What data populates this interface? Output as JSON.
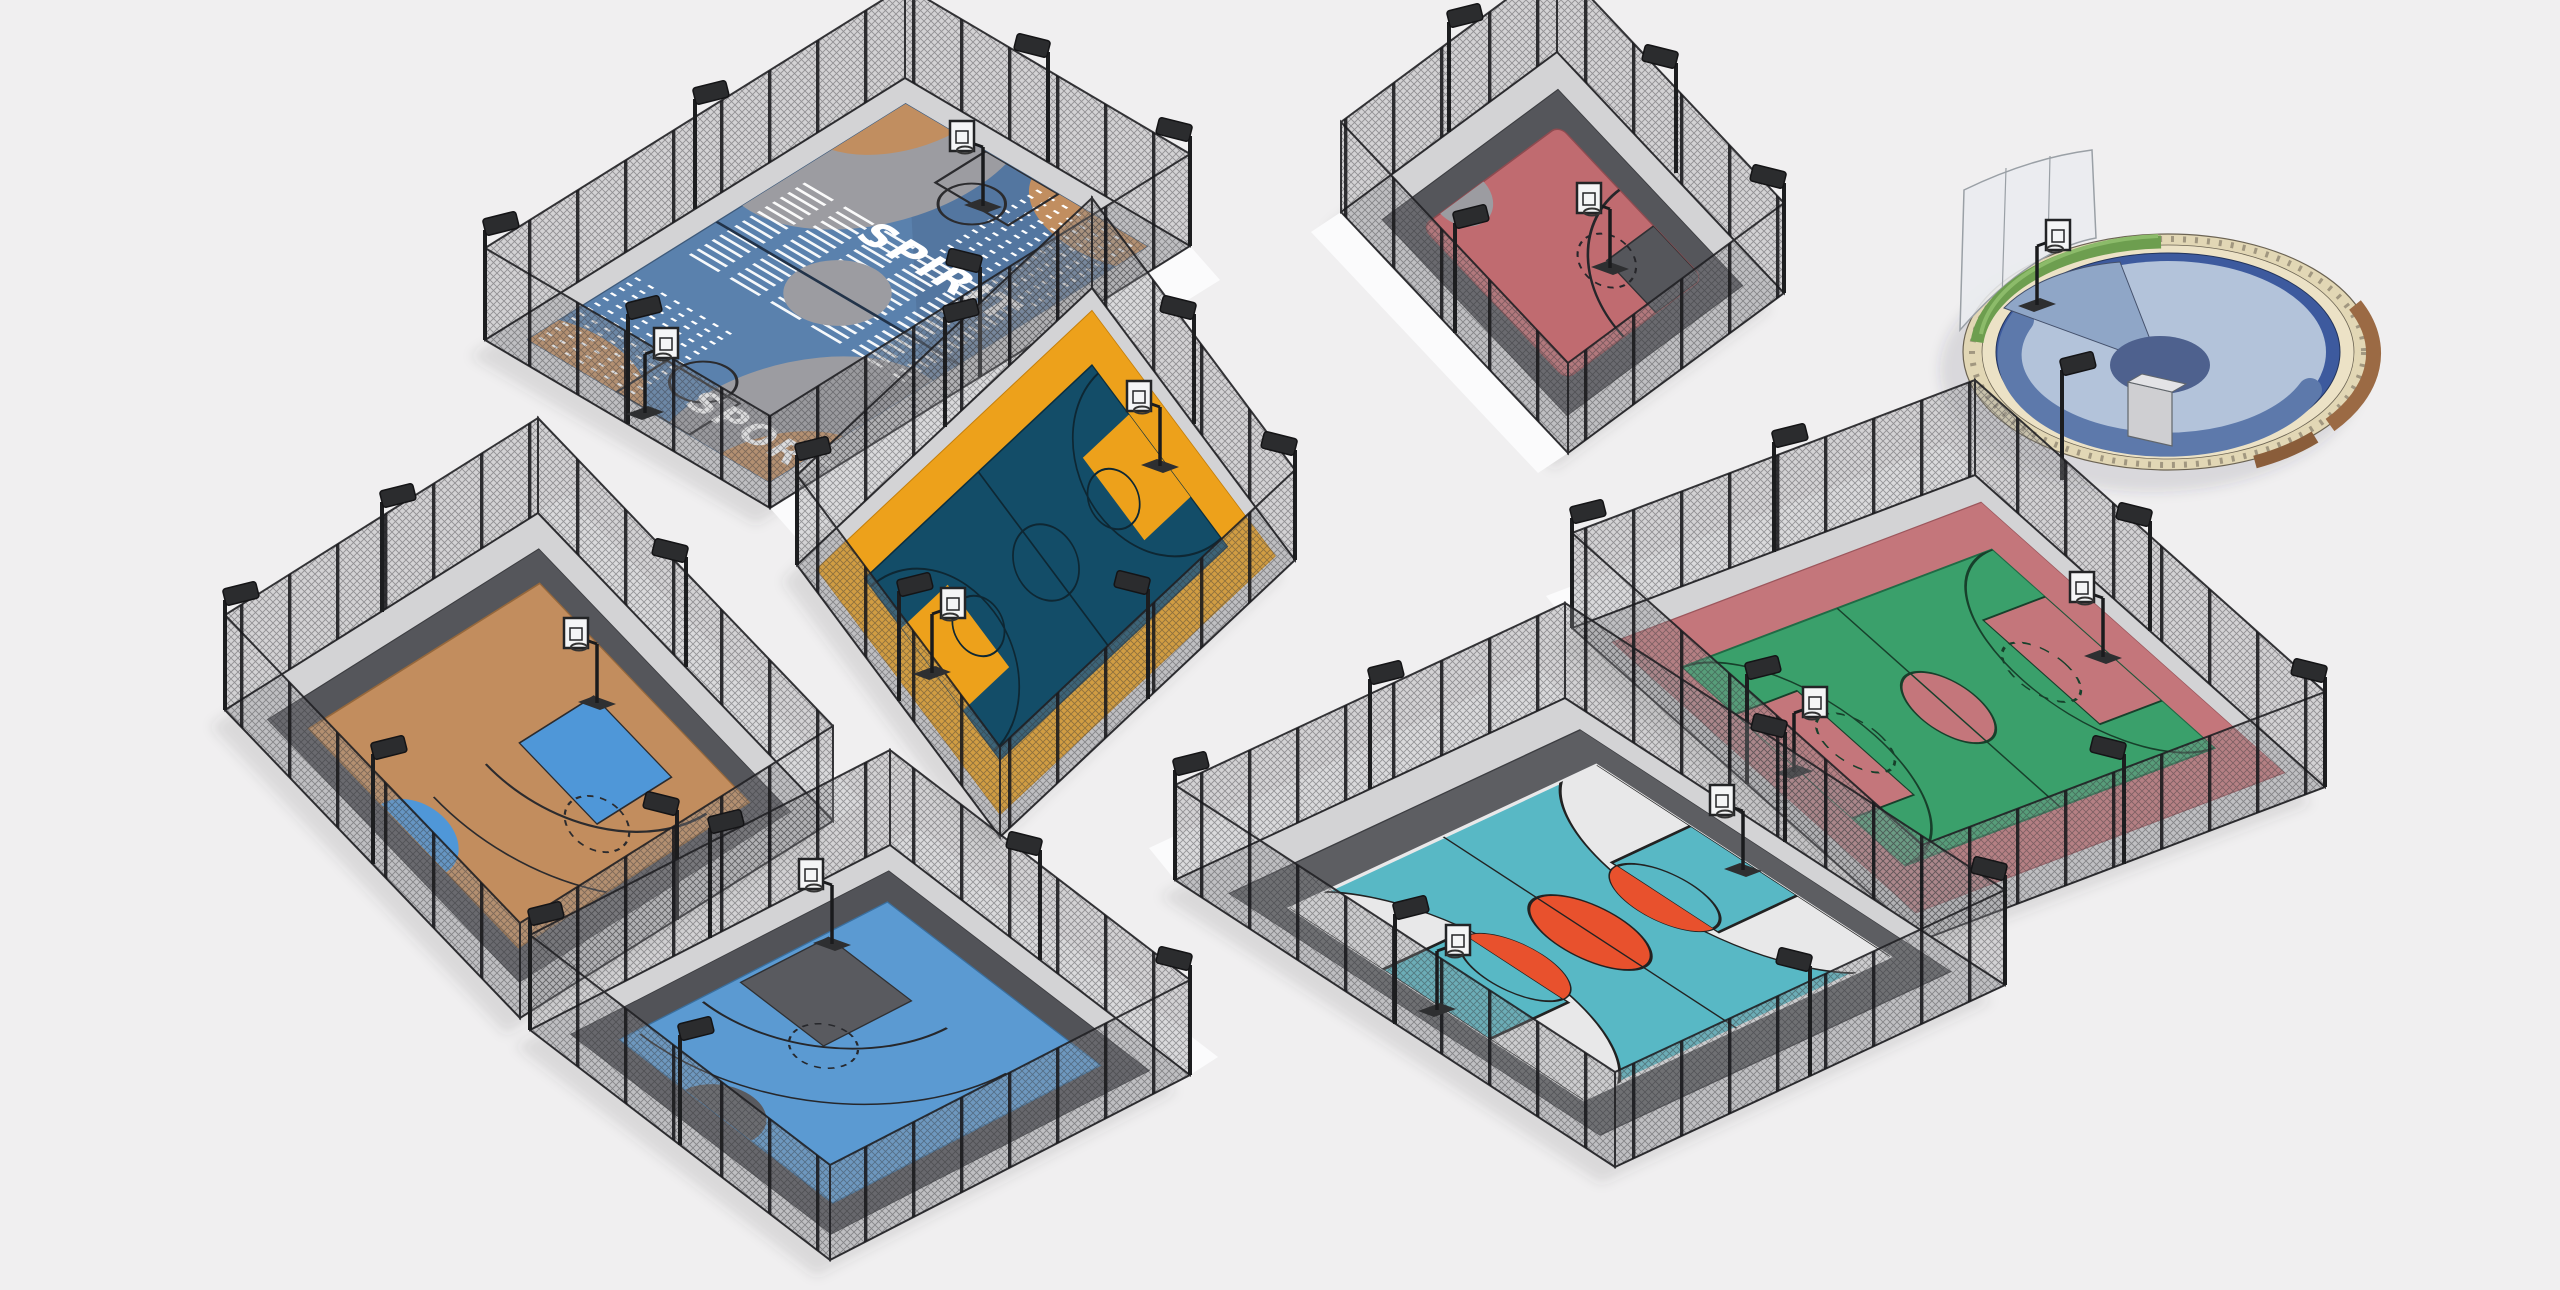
{
  "scene": {
    "description": "Isometric 3D render of eight fenced outdoor streetball basketball courts",
    "background": "#f0eff0",
    "walkway": "#fbfbfc",
    "fence": {
      "mesh": "#8e8e93",
      "frame": "#232327",
      "post": "#1a1a1c"
    },
    "lamp": {
      "pole": "#1c1d1f",
      "head": "#2b2c2e"
    },
    "hoop": {
      "board": "#f4f5f6",
      "frame": "#232426"
    },
    "courts": [
      {
        "id": "spirit-sport-court",
        "name": "Spirit Sport painted full court",
        "type": "full court, fenced",
        "label_primary": "SPIRIT",
        "label_secondary": "SPORT",
        "apron": "#d3d3d5",
        "floor": "#5a81ad",
        "floor_dark": "#4f7097",
        "art_tan": "#c18e60",
        "art_gray": "#9c9ca1",
        "stripes": "#ffffff"
      },
      {
        "id": "red-half-court",
        "name": "Red half court",
        "type": "half court, fenced",
        "apron": "#d3d3d5",
        "apron_inner": "#55565b",
        "floor": "#c06b70",
        "key": "#55565b",
        "accent": "#9c9ca1"
      },
      {
        "id": "round-plaza-court",
        "name": "Round plaza court",
        "type": "circular court, open",
        "surface": "#b3c3da",
        "swoosh": "#5d79ab",
        "sector": "#8fa6c7",
        "sector_center": "#4e618e",
        "ring": "#3d5a9e",
        "stone": "#e2d7b5",
        "steps": "#ece2c6",
        "hedge": "#6d9e4f",
        "bench": "#9b6a44",
        "screen": "#e9ecef"
      },
      {
        "id": "navy-orange-court",
        "name": "Navy and orange full court",
        "type": "full court, fenced",
        "apron": "#d3d3d5",
        "border": "#eda11b",
        "floor": "#134d68",
        "key": "#eda11b",
        "lines": "#0e2733"
      },
      {
        "id": "green-court",
        "name": "Green and rose full court",
        "type": "full court, fenced",
        "apron": "#d3d3d5",
        "border": "#c4767b",
        "floor": "#3aa06b",
        "key": "#c4767b",
        "lines": "#17402b"
      },
      {
        "id": "tan-blue-court",
        "name": "Tan half court with blue key",
        "type": "half court, fenced",
        "apron": "#d3d3d5",
        "apron_inner": "#55565b",
        "floor": "#c28d5e",
        "key": "#4f97d8",
        "lines": "#2b2b2e"
      },
      {
        "id": "blue-half-court",
        "name": "Blue half court",
        "type": "half court, fenced",
        "apron": "#d3d3d5",
        "apron_inner": "#525358",
        "floor": "#5b9ad2",
        "key": "#595a5f",
        "lines": "#26272b"
      },
      {
        "id": "teal-court",
        "name": "Teal and coral full court",
        "type": "full court, fenced",
        "apron": "#d3d3d5",
        "apron_inner": "#5d5e62",
        "floor": "#58b8c5",
        "zone": "#e8e8e9",
        "circle": "#e8512d",
        "lines": "#222222"
      }
    ]
  }
}
